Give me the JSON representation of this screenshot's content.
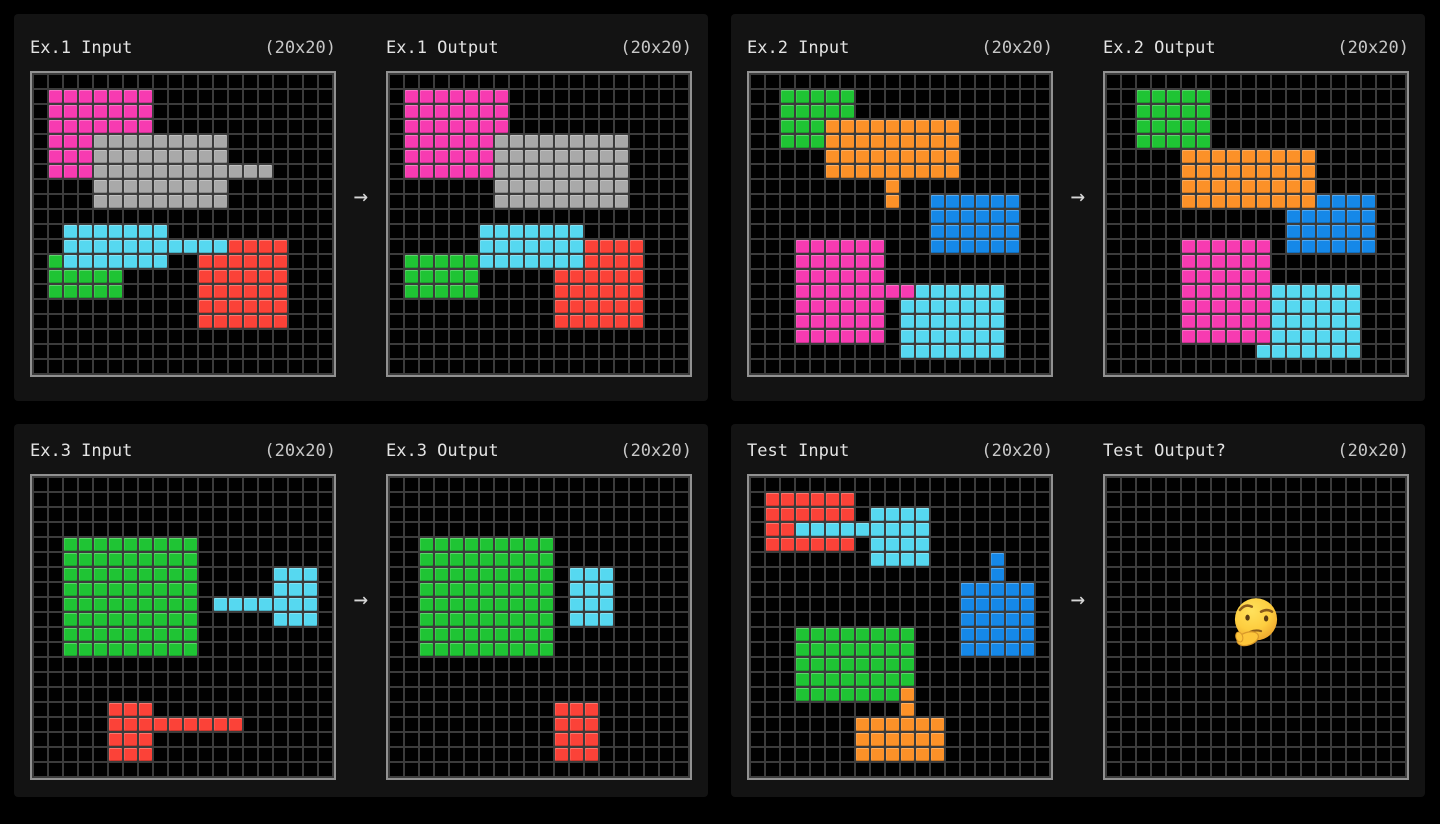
{
  "page": {
    "background": "#000000",
    "panel_background": "#131313",
    "grid_line_color": "#3c3c3c",
    "grid_border_color": "#919191",
    "header_text_color": "#e3e3e3",
    "dims_text_color": "#c7c7c7"
  },
  "arrow_glyph": "→",
  "palette": {
    "G": "#1fc434",
    "M": "#f73bb1",
    "A": "#a9a9a9",
    "C": "#56d8f0",
    "R": "#fb4238",
    "O": "#fc9128",
    "B": "#1588e8",
    ".": "#010101"
  },
  "panels": [
    {
      "name": "example-1",
      "grids": [
        {
          "title": "Ex.1 Input",
          "dims": "(20x20)",
          "rows": [
            "....................",
            ".MMMMMMM............",
            ".MMMMMMM............",
            ".MMMMMMM............",
            ".MMMAAAAAAAAA.......",
            ".MMMAAAAAAAAA.......",
            ".MMMAAAAAAAAAAAA....",
            "....AAAAAAAAA.......",
            "....AAAAAAAAA.......",
            "....................",
            "..CCCCCCC...........",
            "..CCCCCCCCCCCRRRR...",
            ".GCCCCCCC..RRRRRR...",
            ".GGGGG.....RRRRRR...",
            ".GGGGG.....RRRRRR...",
            "...........RRRRRR...",
            "...........RRRRRR...",
            "....................",
            "....................",
            "...................."
          ]
        },
        {
          "title": "Ex.1 Output",
          "dims": "(20x20)",
          "rows": [
            "....................",
            ".MMMMMMM............",
            ".MMMMMMM............",
            ".MMMMMMM............",
            ".MMMMMMAAAAAAAAA....",
            ".MMMMMMAAAAAAAAA....",
            ".MMMMMMAAAAAAAAA....",
            ".......AAAAAAAAA....",
            ".......AAAAAAAAA....",
            "....................",
            "......CCCCCCC.......",
            "......CCCCCCCRRRR...",
            ".GGGGGCCCCCCCRRRR...",
            ".GGGGG.....RRRRRR...",
            ".GGGGG.....RRRRRR...",
            "...........RRRRRR...",
            "...........RRRRRR...",
            "....................",
            "....................",
            "...................."
          ]
        }
      ]
    },
    {
      "name": "example-2",
      "grids": [
        {
          "title": "Ex.2 Input",
          "dims": "(20x20)",
          "rows": [
            "....................",
            "..GGGGG.............",
            "..GGGGG.............",
            "..GGGOOOOOOOOO......",
            "..GGGOOOOOOOOO......",
            ".....OOOOOOOOO......",
            ".....OOOOOOOOO......",
            ".........O..........",
            ".........O..BBBBBB..",
            "............BBBBBB..",
            "............BBBBBB..",
            "...MMMMMM...BBBBBB..",
            "...MMMMMM...........",
            "...MMMMMM...........",
            "...MMMMMMMMCCCCCC...",
            "...MMMMMM.CCCCCCC...",
            "...MMMMMM.CCCCCCC...",
            "...MMMMMM.CCCCCCC...",
            "..........CCCCCCC...",
            "...................."
          ]
        },
        {
          "title": "Ex.2 Output",
          "dims": "(20x20)",
          "rows": [
            "....................",
            "..GGGGG.............",
            "..GGGGG.............",
            "..GGGGG.............",
            "..GGGGG.............",
            ".....OOOOOOOOO......",
            ".....OOOOOOOOO......",
            ".....OOOOOOOOO......",
            ".....OOOOOOOOOBBBB..",
            "............BBBBBB..",
            "............BBBBBB..",
            ".....MMMMMM.BBBBBB..",
            ".....MMMMMM.........",
            ".....MMMMMM.........",
            ".....MMMMMMCCCCCC...",
            ".....MMMMMMCCCCCC...",
            ".....MMMMMMCCCCCC...",
            ".....MMMMMMCCCCCC...",
            "..........CCCCCCC...",
            "...................."
          ]
        }
      ]
    },
    {
      "name": "example-3",
      "grids": [
        {
          "title": "Ex.3 Input",
          "dims": "(20x20)",
          "rows": [
            "....................",
            "....................",
            "....................",
            "....................",
            "..GGGGGGGGG.........",
            "..GGGGGGGGG.........",
            "..GGGGGGGGG.....CCC.",
            "..GGGGGGGGG.....CCC.",
            "..GGGGGGGGG.CCCCCCC.",
            "..GGGGGGGGG.....CCC.",
            "..GGGGGGGGG.........",
            "..GGGGGGGGG.........",
            "....................",
            "....................",
            "....................",
            ".....RRR............",
            ".....RRRRRRRRR......",
            ".....RRR............",
            ".....RRR............",
            "...................."
          ]
        },
        {
          "title": "Ex.3 Output",
          "dims": "(20x20)",
          "rows": [
            "....................",
            "....................",
            "....................",
            "....................",
            "..GGGGGGGGG.........",
            "..GGGGGGGGG.........",
            "..GGGGGGGGG.CCC.....",
            "..GGGGGGGGG.CCC.....",
            "..GGGGGGGGG.CCC.....",
            "..GGGGGGGGG.CCC.....",
            "..GGGGGGGGG.........",
            "..GGGGGGGGG.........",
            "....................",
            "....................",
            "....................",
            "...........RRR......",
            "...........RRR......",
            "...........RRR......",
            "...........RRR......",
            "...................."
          ]
        }
      ]
    },
    {
      "name": "test",
      "grids": [
        {
          "title": "Test Input",
          "dims": "(20x20)",
          "rows": [
            "....................",
            ".RRRRRR.............",
            ".RRRRRR.CCCC........",
            ".RRCCCCCCCCC........",
            ".RRRRRR.CCCC........",
            "........CCCC....B...",
            "................B...",
            "..............BBBBB.",
            "..............BBBBB.",
            "..............BBBBB.",
            "...GGGGGGGG...BBBBB.",
            "...GGGGGGGG...BBBBB.",
            "...GGGGGGGG.........",
            "...GGGGGGGG.........",
            "...GGGGGGGO.........",
            "..........O.........",
            ".......OOOOOO.......",
            ".......OOOOOO.......",
            ".......OOOOOO.......",
            "...................."
          ]
        },
        {
          "title": "Test Output?",
          "dims": "(20x20)",
          "rows": [
            "....................",
            "....................",
            "....................",
            "....................",
            "....................",
            "....................",
            "....................",
            "....................",
            "....................",
            "....................",
            "....................",
            "....................",
            "....................",
            "....................",
            "....................",
            "....................",
            "....................",
            "....................",
            "....................",
            "...................."
          ]
        }
      ]
    }
  ]
}
